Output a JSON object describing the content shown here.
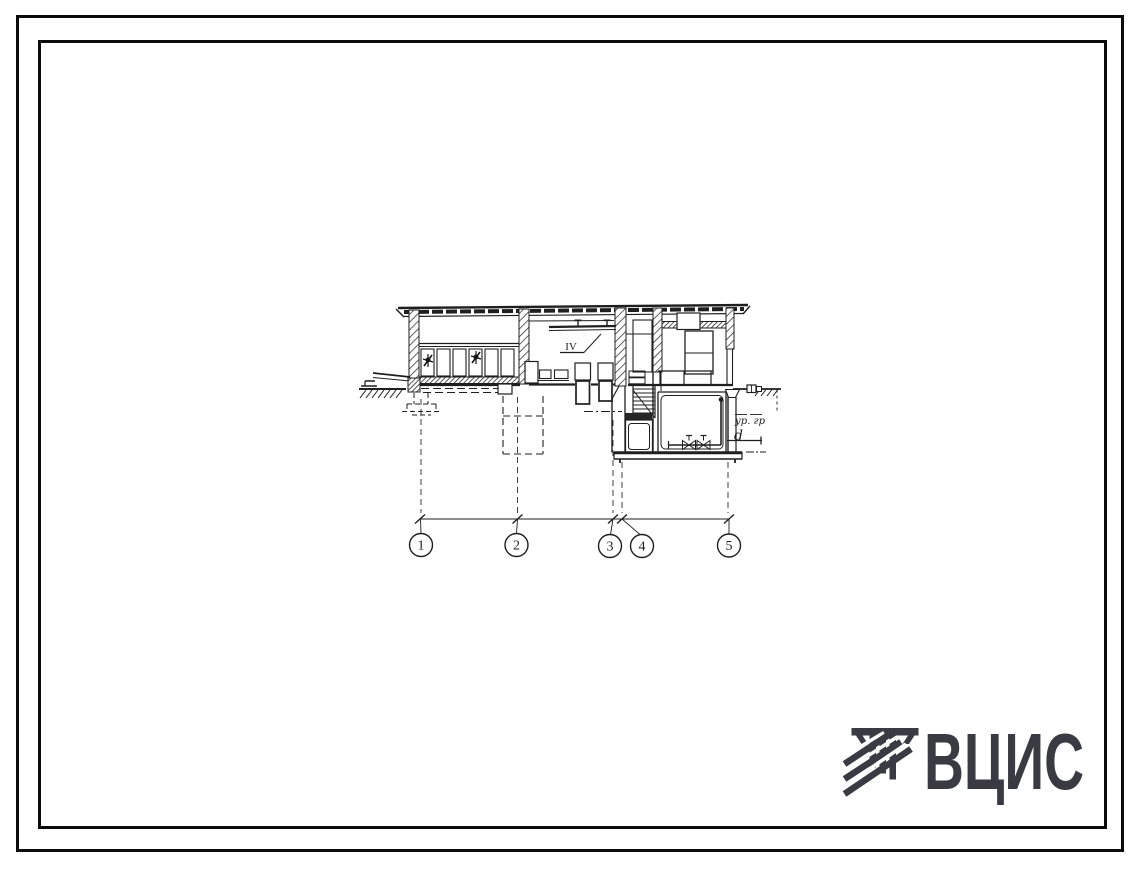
{
  "sheet": {
    "background": "#ffffff",
    "border_color": "#0b0b0b",
    "ink_color": "#1f1f1f"
  },
  "drawing": {
    "axes": [
      {
        "label": "1"
      },
      {
        "label": "2"
      },
      {
        "label": "3"
      },
      {
        "label": "4"
      },
      {
        "label": "5"
      }
    ],
    "labels": {
      "section_mark": "IV",
      "ground_level": "ур. гр",
      "pipe": "d"
    }
  },
  "logo": {
    "text": "ВЦИС",
    "color": "#3a3a42"
  }
}
